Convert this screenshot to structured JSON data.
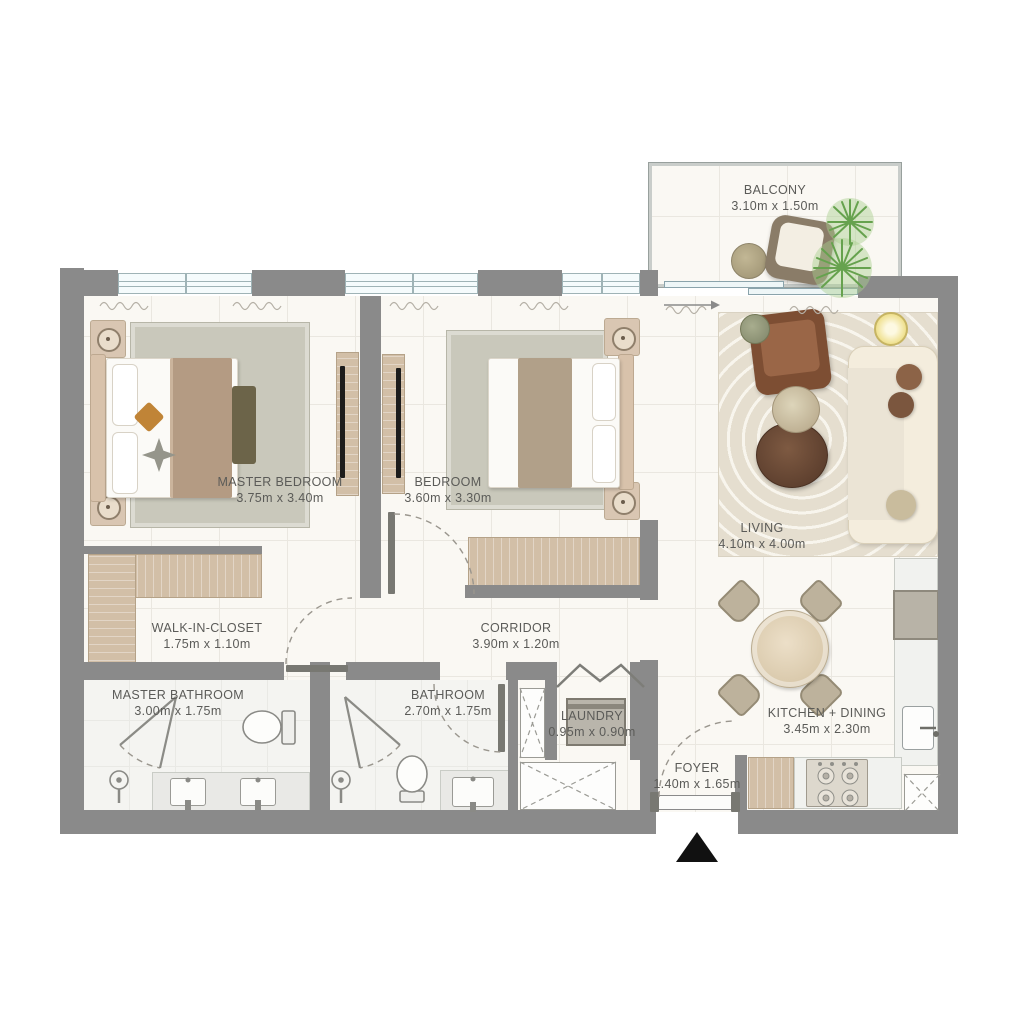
{
  "plan_type": "apartment-floor-plan",
  "rooms": {
    "balcony": {
      "name": "BALCONY",
      "dims": "3.10m x 1.50m"
    },
    "master_bedroom": {
      "name": "MASTER BEDROOM",
      "dims": "3.75m x 3.40m"
    },
    "bedroom": {
      "name": "BEDROOM",
      "dims": "3.60m x 3.30m"
    },
    "living": {
      "name": "LIVING",
      "dims": "4.10m x 4.00m"
    },
    "walk_in_closet": {
      "name": "WALK-IN-CLOSET",
      "dims": "1.75m x 1.10m"
    },
    "corridor": {
      "name": "CORRIDOR",
      "dims": "3.90m x 1.20m"
    },
    "master_bathroom": {
      "name": "MASTER BATHROOM",
      "dims": "3.00m x 1.75m"
    },
    "bathroom": {
      "name": "BATHROOM",
      "dims": "2.70m x 1.75m"
    },
    "laundry": {
      "name": "LAUNDRY",
      "dims": "0.95m x 0.90m"
    },
    "foyer": {
      "name": "FOYER",
      "dims": "1.40m x 1.65m"
    },
    "kitchen_dining": {
      "name": "KITCHEN + DINING",
      "dims": "3.45m x 2.30m"
    }
  },
  "palette": {
    "wall": "#8a8a8a",
    "floor": "#faf8f3",
    "wood": "#d2bfa7",
    "rug": "#c9c8bb",
    "living_rug": "#e5decf",
    "sofa": "#f4eddd",
    "armchair_brown": "#7d4e33",
    "plant_green": "#66a24e",
    "text": "#5b5b58",
    "entrance_marker": "#111111"
  },
  "icons": {
    "entrance_marker": "up-triangle"
  }
}
